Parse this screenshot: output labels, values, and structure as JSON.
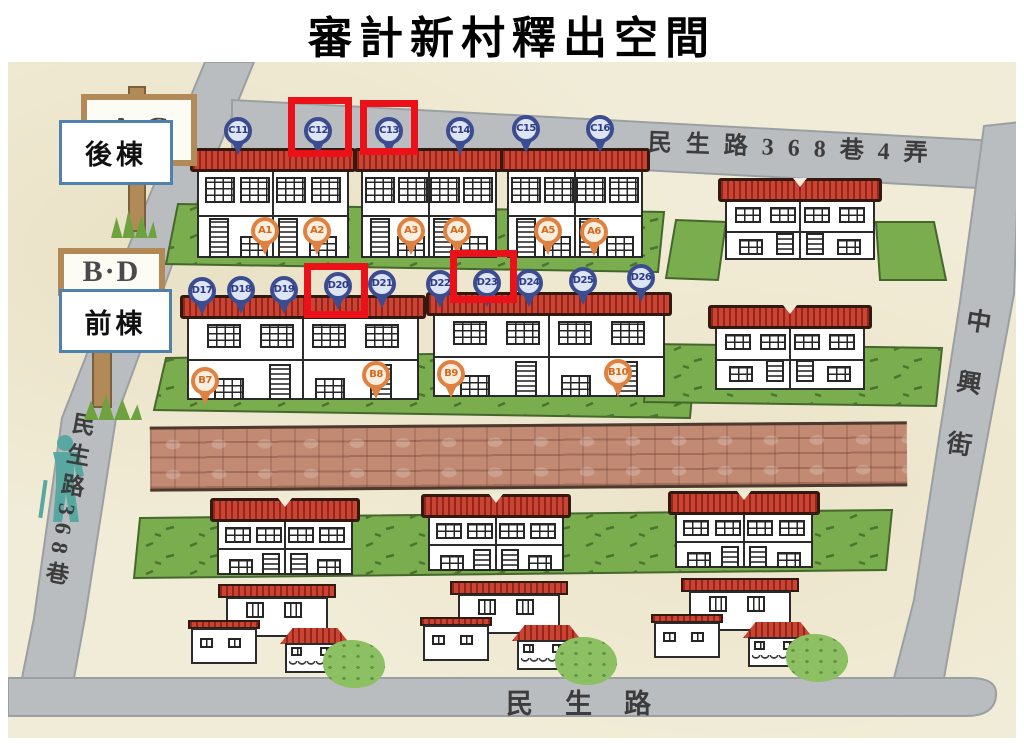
{
  "title": "審計新村釋出空間",
  "map": {
    "streets": {
      "top": "民生路368巷4弄",
      "left": "民生路368巷",
      "right": "中興街",
      "bottom": "民生路"
    },
    "signs": {
      "back": "A·C",
      "front": "B·D"
    },
    "row_labels": {
      "back": "後棟",
      "front": "前棟"
    },
    "pins": [
      {
        "label": "C11",
        "type": "blue",
        "x": 230,
        "y": 69
      },
      {
        "label": "C12",
        "type": "blue",
        "x": 310,
        "y": 69
      },
      {
        "label": "C13",
        "type": "blue",
        "x": 381,
        "y": 69
      },
      {
        "label": "C14",
        "type": "blue",
        "x": 452,
        "y": 69
      },
      {
        "label": "C15",
        "type": "blue",
        "x": 518,
        "y": 67
      },
      {
        "label": "C16",
        "type": "blue",
        "x": 592,
        "y": 67
      },
      {
        "label": "A1",
        "type": "orange",
        "x": 257,
        "y": 169
      },
      {
        "label": "A2",
        "type": "orange",
        "x": 309,
        "y": 169
      },
      {
        "label": "A3",
        "type": "orange",
        "x": 403,
        "y": 169
      },
      {
        "label": "A4",
        "type": "orange",
        "x": 449,
        "y": 169
      },
      {
        "label": "A5",
        "type": "orange",
        "x": 540,
        "y": 169
      },
      {
        "label": "A6",
        "type": "orange",
        "x": 586,
        "y": 170
      },
      {
        "label": "D17",
        "type": "blue",
        "x": 194,
        "y": 229
      },
      {
        "label": "D18",
        "type": "blue",
        "x": 233,
        "y": 228
      },
      {
        "label": "D19",
        "type": "blue",
        "x": 276,
        "y": 228
      },
      {
        "label": "D20",
        "type": "blue",
        "x": 330,
        "y": 224
      },
      {
        "label": "D21",
        "type": "blue",
        "x": 374,
        "y": 222
      },
      {
        "label": "D22",
        "type": "blue",
        "x": 432,
        "y": 222
      },
      {
        "label": "D23",
        "type": "blue",
        "x": 479,
        "y": 221
      },
      {
        "label": "D24",
        "type": "blue",
        "x": 521,
        "y": 221
      },
      {
        "label": "D25",
        "type": "blue",
        "x": 575,
        "y": 219
      },
      {
        "label": "D26",
        "type": "blue",
        "x": 633,
        "y": 216
      },
      {
        "label": "B7",
        "type": "orange",
        "x": 197,
        "y": 319
      },
      {
        "label": "B8",
        "type": "orange",
        "x": 368,
        "y": 313
      },
      {
        "label": "B9",
        "type": "orange",
        "x": 443,
        "y": 312
      },
      {
        "label": "B10",
        "type": "orange",
        "x": 610,
        "y": 311
      }
    ],
    "highlights": [
      {
        "label": "C12",
        "x": 280,
        "y": 35,
        "w": 64,
        "h": 60
      },
      {
        "label": "C13",
        "x": 352,
        "y": 38,
        "w": 58,
        "h": 55
      },
      {
        "label": "D20",
        "x": 296,
        "y": 201,
        "w": 64,
        "h": 55
      },
      {
        "label": "D23",
        "x": 442,
        "y": 188,
        "w": 67,
        "h": 53
      }
    ],
    "colors": {
      "pin_blue": "#3c4c90",
      "pin_orange": "#df8141",
      "highlight_red": "#eb1118",
      "label_border_blue": "#4f81ae",
      "roof_red": "#ca4333",
      "grass_green": "#79ad4e",
      "road_gray": "#b9bdc0",
      "background_beige": "#f1ecd7",
      "brick_path": "#c28973",
      "person_teal": "#58a8a1"
    }
  }
}
